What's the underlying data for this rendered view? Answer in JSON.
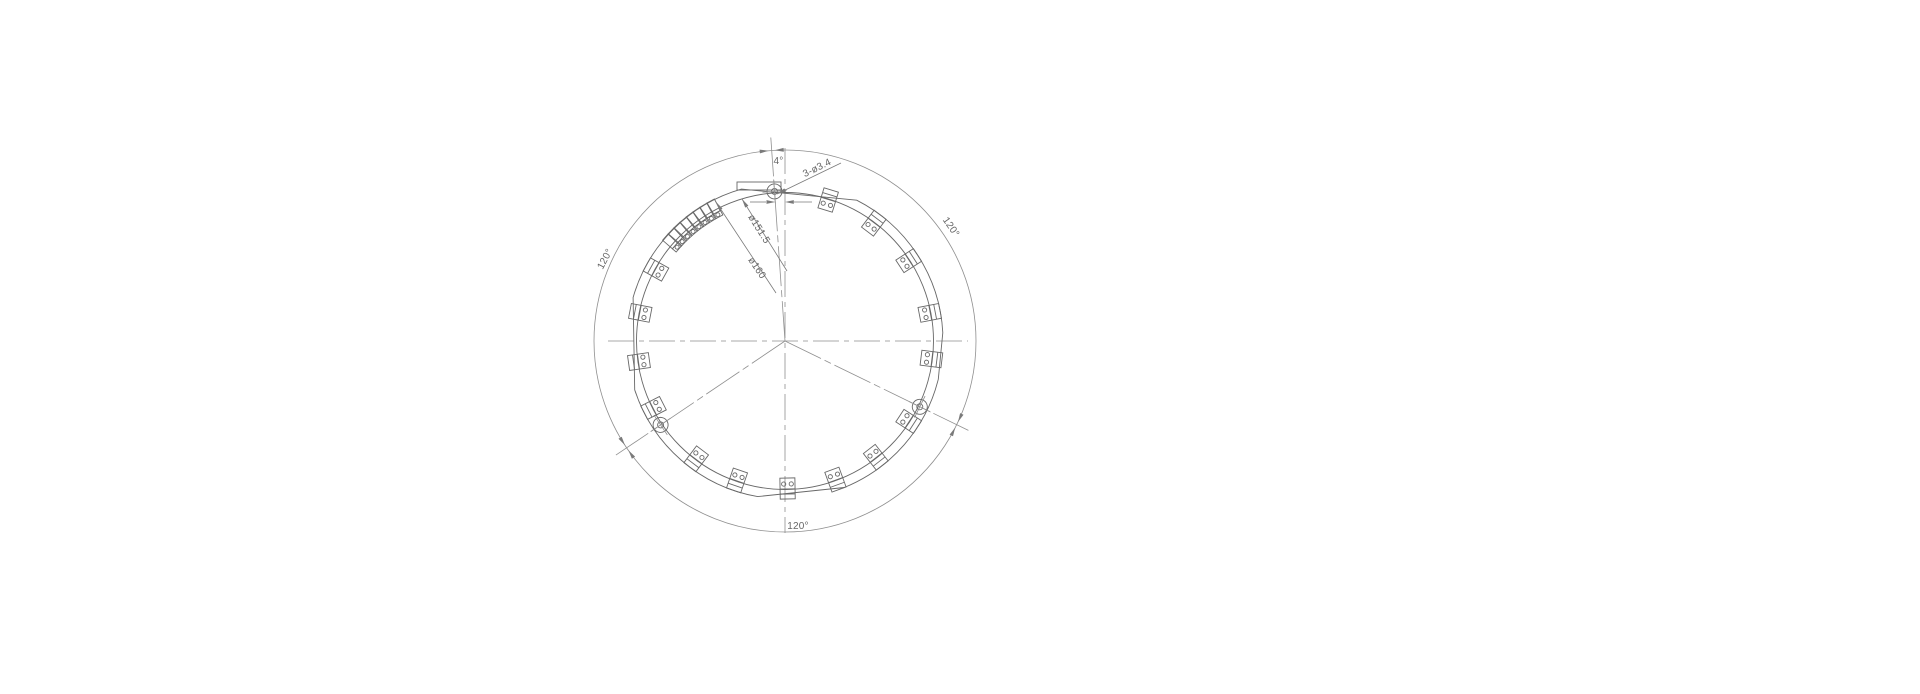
{
  "drawing": {
    "labels": {
      "angle_offset": "4°",
      "holes_callout": "3-ø3.4",
      "inner_diameter": "ø151.5",
      "outer_diameter": "ø160",
      "arc_upper_left": "120°",
      "arc_upper_right": "120°",
      "arc_bottom": "120°"
    },
    "colors": {
      "background": "#ffffff",
      "line": "#686868",
      "thin_line": "#8f8f8f",
      "dim_line": "#7a7a7a",
      "text": "#666666"
    },
    "geometry": {
      "center": {
        "x": 785,
        "y": 341
      },
      "radius_outer": 158,
      "radius_inner": 148.5,
      "radius_dim_arc": 191,
      "radius_bolt": 150,
      "hole_angles": [
        -94,
        26,
        146
      ],
      "block_angles": [
        -73,
        -53,
        -33,
        -11,
        7,
        33,
        52,
        70,
        89,
        109,
        127,
        153,
        172,
        -169,
        -151
      ],
      "strip": {
        "start_angle": -139,
        "pitch_deg": 3,
        "cells": 8,
        "radius": 149.5
      },
      "flats": [
        [
          -106,
          -63
        ],
        [
          -3,
          14
        ],
        [
          68,
          100
        ],
        [
          162,
          196
        ]
      ]
    }
  }
}
